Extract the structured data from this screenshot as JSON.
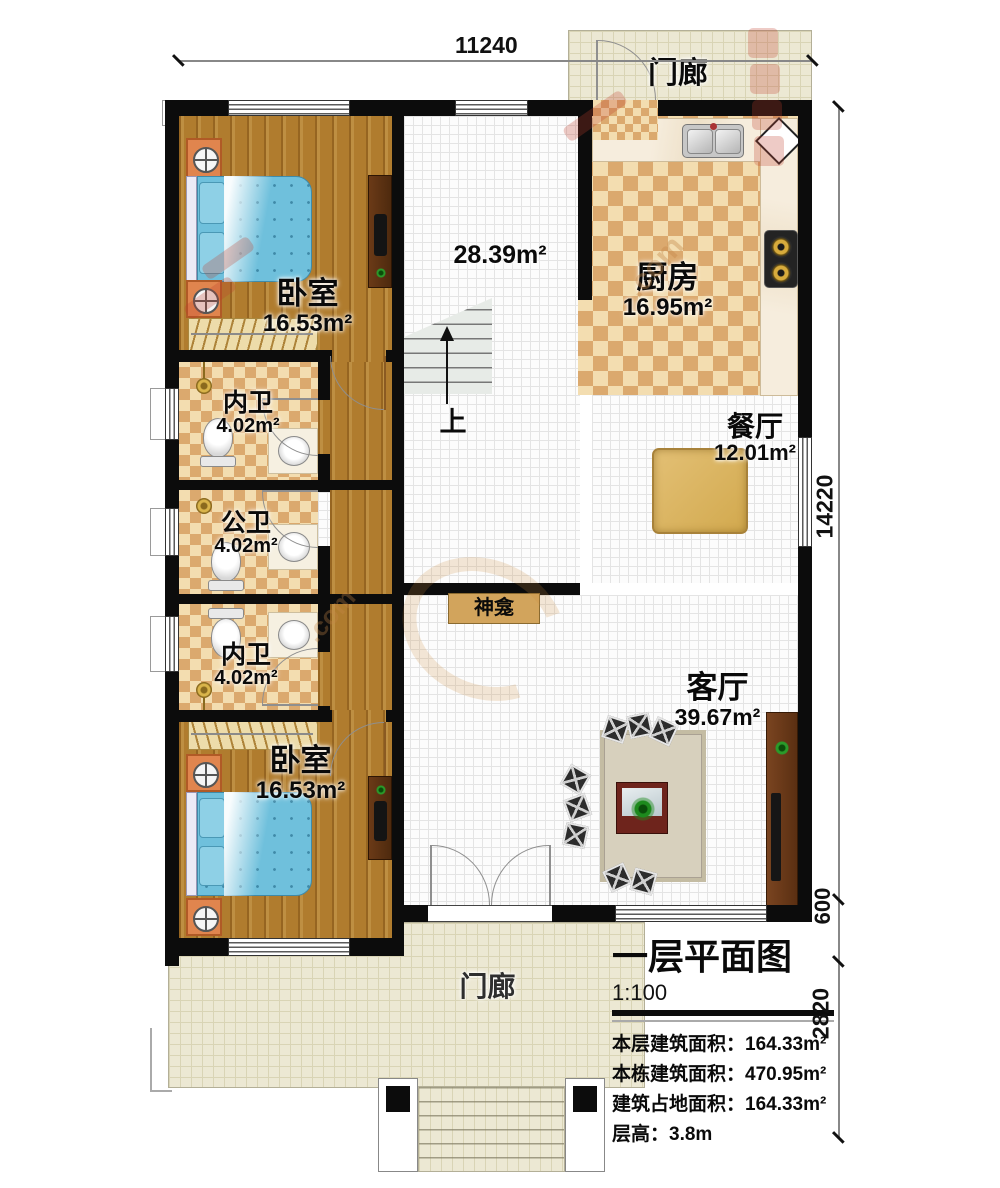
{
  "dimensions": {
    "top": "11240",
    "right_main": "14220",
    "right_mid": "600",
    "right_bottom": "2820"
  },
  "rooms": {
    "porch_top": {
      "name": "门廊"
    },
    "kitchen": {
      "name": "厨房",
      "area": "16.95m²"
    },
    "dining": {
      "name": "餐厅",
      "area": "12.01m²"
    },
    "bedroom_top": {
      "name": "卧室",
      "area": "16.53m²"
    },
    "bath_top": {
      "name": "内卫",
      "area": "4.02m²"
    },
    "bath_mid": {
      "name": "公卫",
      "area": "4.02m²"
    },
    "bath_bottom": {
      "name": "内卫",
      "area": "4.02m²"
    },
    "bedroom_bottom": {
      "name": "卧室",
      "area": "16.53m²"
    },
    "living": {
      "name": "客厅",
      "area": "39.67m²"
    },
    "hall": {
      "area": "28.39m²"
    },
    "shrine": {
      "name": "神龛"
    },
    "stairs": {
      "up": "上"
    },
    "porch_bottom": {
      "name": "门廊"
    }
  },
  "title_block": {
    "title": "一层平面图",
    "scale": "1:100",
    "lines": [
      {
        "label": "本层建筑面积：",
        "value": "164.33m²"
      },
      {
        "label": "本栋建筑面积：",
        "value": "470.95m²"
      },
      {
        "label": "建筑占地面积：",
        "value": "164.33m²"
      },
      {
        "label": "层高：",
        "value": "3.8m"
      }
    ]
  },
  "watermark": {
    "fragment": ".com"
  },
  "colors": {
    "wall": "#0c0c0c",
    "wood_floor": "#b07c2e",
    "tile_accent": "#dba96e",
    "porch_floor": "#ece8d3",
    "bed": "#6fc0dc",
    "watermark_red": "#c13e2c"
  }
}
